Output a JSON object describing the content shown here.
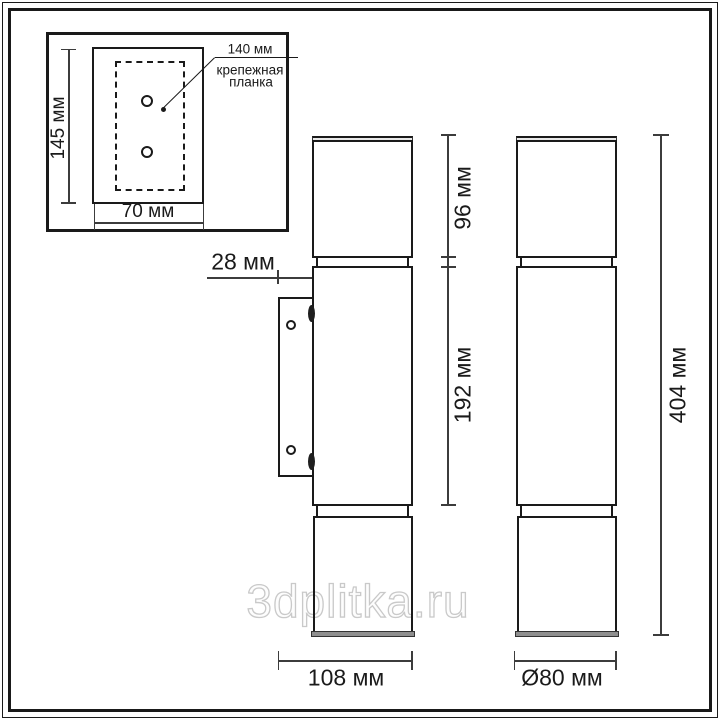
{
  "watermark": {
    "text": "3dplitka.ru"
  },
  "inset": {
    "plate_height": "145 мм",
    "plate_width": "70 мм",
    "hole_spacing": "140 мм",
    "caption_line1": "крепежная",
    "caption_line2": "планка"
  },
  "side_view": {
    "wall_offset": "28 мм",
    "depth": "108 мм"
  },
  "front_view": {
    "top_section_height": "96 мм",
    "middle_section_height": "192 мм",
    "total_height": "404 мм",
    "diameter": "Ø80 мм"
  },
  "colors": {
    "background": "#ffffff",
    "line": "#1a1a1a",
    "dimension_line": "#3c3c3c",
    "text": "#1a1a1a",
    "cap_fill": "#8f8f8f",
    "cap_top_fill": "#e8e8e8",
    "watermark_outline": "#c9c9c9"
  }
}
